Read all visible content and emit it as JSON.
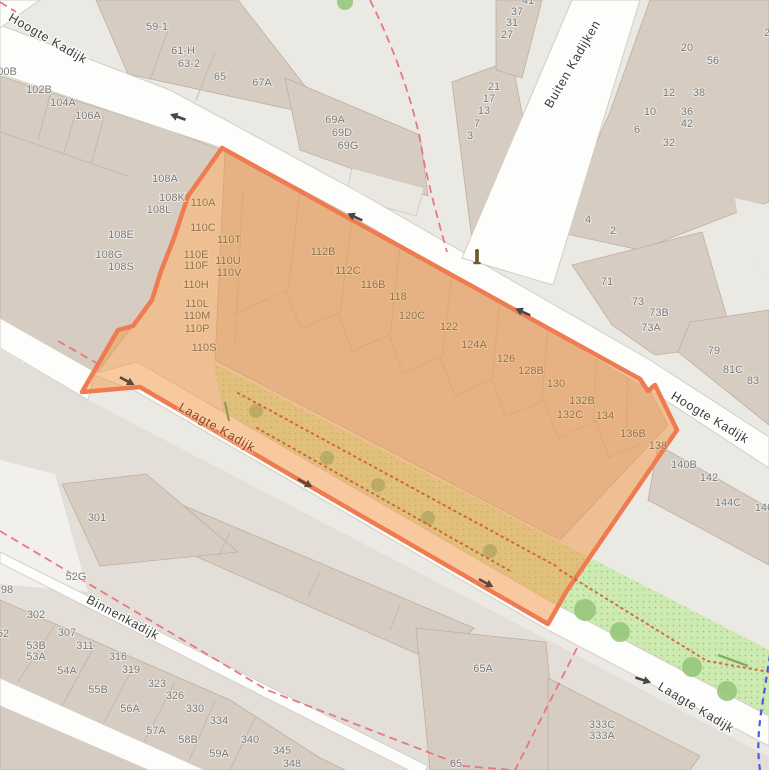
{
  "map": {
    "title": "Street map with highlighted selection area (Kadijken, Amsterdam)",
    "selection": {
      "name": "highlighted-area",
      "fill": "#F49A4A",
      "border": "#EE7C50"
    },
    "colors": {
      "land": "#EBE9E4",
      "residential": "#E3DED7",
      "building": "#D7CCC1",
      "building_outline": "#BDAFA0",
      "street": "#FDFDFB",
      "green": "#CDEAB0",
      "boundary_dash": "#E5737F",
      "footpath_dots": "#D4552E",
      "route_blue": "#4D58E3"
    },
    "street_labels": [
      {
        "text": "Hoogte Kadijk",
        "x": 46,
        "y": 42,
        "rotate": 30,
        "variant": "out"
      },
      {
        "text": "Buiten Kadijken",
        "x": 576,
        "y": 66,
        "rotate": -60,
        "variant": "out"
      },
      {
        "text": "Hoogte Kadijk",
        "x": 708,
        "y": 421,
        "rotate": 31,
        "variant": "out"
      },
      {
        "text": "Laagte Kadijk",
        "x": 215,
        "y": 431,
        "rotate": 30,
        "variant": "in"
      },
      {
        "text": "Laagte Kadijk",
        "x": 694,
        "y": 711,
        "rotate": 31,
        "variant": "out"
      },
      {
        "text": "Binnenkadijk",
        "x": 121,
        "y": 621,
        "rotate": 28,
        "variant": "out"
      }
    ],
    "house_numbers": [
      {
        "text": "100B",
        "x": 4,
        "y": 75,
        "zone": "out"
      },
      {
        "text": "102B",
        "x": 39,
        "y": 93,
        "zone": "out"
      },
      {
        "text": "104A",
        "x": 63,
        "y": 106,
        "zone": "out"
      },
      {
        "text": "106A",
        "x": 88,
        "y": 119,
        "zone": "out"
      },
      {
        "text": "59-1",
        "x": 157,
        "y": 30,
        "zone": "out"
      },
      {
        "text": "61-H",
        "x": 183,
        "y": 54,
        "zone": "out"
      },
      {
        "text": "63-2",
        "x": 189,
        "y": 67,
        "zone": "out"
      },
      {
        "text": "65",
        "x": 220,
        "y": 80,
        "zone": "out"
      },
      {
        "text": "67A",
        "x": 262,
        "y": 86,
        "zone": "out"
      },
      {
        "text": "69A",
        "x": 335,
        "y": 123,
        "zone": "out"
      },
      {
        "text": "69D",
        "x": 342,
        "y": 136,
        "zone": "out"
      },
      {
        "text": "69G",
        "x": 348,
        "y": 149,
        "zone": "out"
      },
      {
        "text": "41",
        "x": 528,
        "y": 4,
        "zone": "out"
      },
      {
        "text": "37",
        "x": 517,
        "y": 15,
        "zone": "out"
      },
      {
        "text": "31",
        "x": 512,
        "y": 26,
        "zone": "out"
      },
      {
        "text": "27",
        "x": 507,
        "y": 38,
        "zone": "out"
      },
      {
        "text": "21",
        "x": 494,
        "y": 90,
        "zone": "out"
      },
      {
        "text": "17",
        "x": 489,
        "y": 102,
        "zone": "out"
      },
      {
        "text": "13",
        "x": 484,
        "y": 114,
        "zone": "out"
      },
      {
        "text": "7",
        "x": 477,
        "y": 127,
        "zone": "out"
      },
      {
        "text": "3",
        "x": 470,
        "y": 139,
        "zone": "out"
      },
      {
        "text": "20",
        "x": 687,
        "y": 51,
        "zone": "out"
      },
      {
        "text": "56",
        "x": 713,
        "y": 64,
        "zone": "out"
      },
      {
        "text": "12",
        "x": 669,
        "y": 96,
        "zone": "out"
      },
      {
        "text": "38",
        "x": 699,
        "y": 96,
        "zone": "out"
      },
      {
        "text": "10",
        "x": 650,
        "y": 115,
        "zone": "out"
      },
      {
        "text": "36",
        "x": 687,
        "y": 115,
        "zone": "out"
      },
      {
        "text": "42",
        "x": 687,
        "y": 127,
        "zone": "out"
      },
      {
        "text": "6",
        "x": 637,
        "y": 133,
        "zone": "out"
      },
      {
        "text": "32",
        "x": 669,
        "y": 146,
        "zone": "out"
      },
      {
        "text": "2",
        "x": 767,
        "y": 36,
        "zone": "out"
      },
      {
        "text": "108A",
        "x": 165,
        "y": 182,
        "zone": "out"
      },
      {
        "text": "108K",
        "x": 172,
        "y": 201,
        "zone": "out"
      },
      {
        "text": "108L",
        "x": 159,
        "y": 213,
        "zone": "out"
      },
      {
        "text": "108E",
        "x": 121,
        "y": 238,
        "zone": "out"
      },
      {
        "text": "108G",
        "x": 109,
        "y": 258,
        "zone": "out"
      },
      {
        "text": "108S",
        "x": 121,
        "y": 270,
        "zone": "out"
      },
      {
        "text": "4",
        "x": 588,
        "y": 223,
        "zone": "out"
      },
      {
        "text": "2",
        "x": 613,
        "y": 234,
        "zone": "out"
      },
      {
        "text": "71",
        "x": 607,
        "y": 285,
        "zone": "out"
      },
      {
        "text": "73",
        "x": 638,
        "y": 305,
        "zone": "out"
      },
      {
        "text": "73B",
        "x": 659,
        "y": 316,
        "zone": "out"
      },
      {
        "text": "73A",
        "x": 651,
        "y": 331,
        "zone": "out"
      },
      {
        "text": "79",
        "x": 714,
        "y": 354,
        "zone": "out"
      },
      {
        "text": "81C",
        "x": 733,
        "y": 373,
        "zone": "out"
      },
      {
        "text": "83",
        "x": 753,
        "y": 384,
        "zone": "out"
      },
      {
        "text": "140B",
        "x": 684,
        "y": 468,
        "zone": "out"
      },
      {
        "text": "142",
        "x": 709,
        "y": 481,
        "zone": "out"
      },
      {
        "text": "144C",
        "x": 728,
        "y": 506,
        "zone": "out"
      },
      {
        "text": "146",
        "x": 764,
        "y": 511,
        "zone": "out"
      },
      {
        "text": "301",
        "x": 97,
        "y": 521,
        "zone": "out"
      },
      {
        "text": "52G",
        "x": 76,
        "y": 580,
        "zone": "out"
      },
      {
        "text": "98",
        "x": 7,
        "y": 593,
        "zone": "out"
      },
      {
        "text": "302",
        "x": 36,
        "y": 618,
        "zone": "out"
      },
      {
        "text": "62",
        "x": 3,
        "y": 637,
        "zone": "out"
      },
      {
        "text": "307",
        "x": 67,
        "y": 636,
        "zone": "out"
      },
      {
        "text": "53B",
        "x": 36,
        "y": 649,
        "zone": "out"
      },
      {
        "text": "53A",
        "x": 36,
        "y": 660,
        "zone": "out"
      },
      {
        "text": "311",
        "x": 85,
        "y": 649,
        "zone": "out"
      },
      {
        "text": "54A",
        "x": 67,
        "y": 674,
        "zone": "out"
      },
      {
        "text": "316",
        "x": 118,
        "y": 660,
        "zone": "out"
      },
      {
        "text": "319",
        "x": 131,
        "y": 673,
        "zone": "out"
      },
      {
        "text": "55B",
        "x": 98,
        "y": 693,
        "zone": "out"
      },
      {
        "text": "323",
        "x": 157,
        "y": 687,
        "zone": "out"
      },
      {
        "text": "326",
        "x": 175,
        "y": 699,
        "zone": "out"
      },
      {
        "text": "56A",
        "x": 130,
        "y": 712,
        "zone": "out"
      },
      {
        "text": "330",
        "x": 195,
        "y": 712,
        "zone": "out"
      },
      {
        "text": "57A",
        "x": 156,
        "y": 734,
        "zone": "out"
      },
      {
        "text": "334",
        "x": 219,
        "y": 724,
        "zone": "out"
      },
      {
        "text": "58B",
        "x": 188,
        "y": 743,
        "zone": "out"
      },
      {
        "text": "340",
        "x": 250,
        "y": 743,
        "zone": "out"
      },
      {
        "text": "59A",
        "x": 219,
        "y": 757,
        "zone": "out"
      },
      {
        "text": "345",
        "x": 282,
        "y": 754,
        "zone": "out"
      },
      {
        "text": "348",
        "x": 292,
        "y": 767,
        "zone": "out"
      },
      {
        "text": "65A",
        "x": 483,
        "y": 672,
        "zone": "out"
      },
      {
        "text": "65",
        "x": 456,
        "y": 767,
        "zone": "out"
      },
      {
        "text": "333C",
        "x": 602,
        "y": 728,
        "zone": "out"
      },
      {
        "text": "333A",
        "x": 602,
        "y": 739,
        "zone": "out"
      },
      {
        "text": "110A",
        "x": 203,
        "y": 206,
        "zone": "in"
      },
      {
        "text": "110C",
        "x": 203,
        "y": 231,
        "zone": "in"
      },
      {
        "text": "110T",
        "x": 229,
        "y": 243,
        "zone": "in"
      },
      {
        "text": "110E",
        "x": 196,
        "y": 258,
        "zone": "in"
      },
      {
        "text": "110U",
        "x": 228,
        "y": 264,
        "zone": "in"
      },
      {
        "text": "110F",
        "x": 196,
        "y": 269,
        "zone": "in"
      },
      {
        "text": "110V",
        "x": 229,
        "y": 276,
        "zone": "in"
      },
      {
        "text": "110H",
        "x": 196,
        "y": 288,
        "zone": "in"
      },
      {
        "text": "110L",
        "x": 197,
        "y": 307,
        "zone": "in"
      },
      {
        "text": "110M",
        "x": 197,
        "y": 319,
        "zone": "in"
      },
      {
        "text": "110P",
        "x": 197,
        "y": 332,
        "zone": "in"
      },
      {
        "text": "110S",
        "x": 204,
        "y": 351,
        "zone": "in"
      },
      {
        "text": "112B",
        "x": 323,
        "y": 255,
        "zone": "in"
      },
      {
        "text": "112C",
        "x": 348,
        "y": 274,
        "zone": "in"
      },
      {
        "text": "116B",
        "x": 373,
        "y": 288,
        "zone": "in"
      },
      {
        "text": "118",
        "x": 398,
        "y": 300,
        "zone": "in"
      },
      {
        "text": "120C",
        "x": 412,
        "y": 319,
        "zone": "in"
      },
      {
        "text": "122",
        "x": 449,
        "y": 330,
        "zone": "in"
      },
      {
        "text": "124A",
        "x": 474,
        "y": 348,
        "zone": "in"
      },
      {
        "text": "126",
        "x": 506,
        "y": 362,
        "zone": "in"
      },
      {
        "text": "128B",
        "x": 531,
        "y": 374,
        "zone": "in"
      },
      {
        "text": "130",
        "x": 556,
        "y": 387,
        "zone": "in"
      },
      {
        "text": "132B",
        "x": 582,
        "y": 404,
        "zone": "in"
      },
      {
        "text": "132C",
        "x": 570,
        "y": 418,
        "zone": "in"
      },
      {
        "text": "134",
        "x": 605,
        "y": 419,
        "zone": "in"
      },
      {
        "text": "136B",
        "x": 633,
        "y": 437,
        "zone": "in"
      },
      {
        "text": "138",
        "x": 658,
        "y": 449,
        "zone": "in"
      }
    ],
    "oneway_arrows": [
      {
        "x": 178,
        "y": 117,
        "rotate": 200,
        "zone": "out"
      },
      {
        "x": 355,
        "y": 217,
        "rotate": 205,
        "zone": "out"
      },
      {
        "x": 523,
        "y": 312,
        "rotate": 205,
        "zone": "out"
      },
      {
        "x": 127,
        "y": 381,
        "rotate": 28,
        "zone": "in"
      },
      {
        "x": 305,
        "y": 483,
        "rotate": 29,
        "zone": "in"
      },
      {
        "x": 486,
        "y": 583,
        "rotate": 29,
        "zone": "in"
      },
      {
        "x": 643,
        "y": 680,
        "rotate": 18,
        "zone": "out"
      }
    ],
    "trees_inside": [
      {
        "x": 256,
        "y": 411,
        "r": 7
      },
      {
        "x": 327,
        "y": 458,
        "r": 7
      },
      {
        "x": 378,
        "y": 485,
        "r": 7
      },
      {
        "x": 428,
        "y": 518,
        "r": 7
      },
      {
        "x": 490,
        "y": 551,
        "r": 7
      }
    ],
    "trees_outside": [
      {
        "x": 585,
        "y": 610,
        "r": 11
      },
      {
        "x": 620,
        "y": 632,
        "r": 10
      },
      {
        "x": 692,
        "y": 667,
        "r": 10
      },
      {
        "x": 727,
        "y": 691,
        "r": 10
      },
      {
        "x": 345,
        "y": 2,
        "r": 8
      }
    ],
    "monument_icon": {
      "x": 477,
      "y": 258,
      "name": "bollard-monument-icon"
    }
  }
}
